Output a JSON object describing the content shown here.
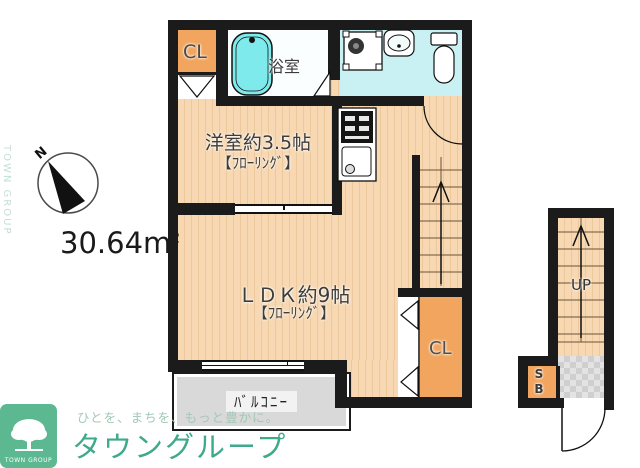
{
  "floorplan": {
    "area_value": "30.64m",
    "area_superscript": "2",
    "compass_north": "N",
    "rooms": {
      "closet_top": "CL",
      "bath": "浴室",
      "western_room_line1": "洋室約3.5帖",
      "western_room_line2": "【ﾌﾛｰﾘﾝｸﾞ】",
      "ldk_line1": "ＬＤＫ約9帖",
      "ldk_line2": "【ﾌﾛｰﾘﾝｸﾞ】",
      "closet_bottom": "CL",
      "balcony": "ﾊﾞﾙｺﾆｰ",
      "stairs_up": "UP",
      "shoe_box": "SB"
    },
    "icons": {
      "compass": "circle-with-black-north-wedge",
      "bathtub": "rounded-rect-tub",
      "toilet": "tank-and-bowl",
      "washbasin": "rounded-rect-with-oval",
      "washer_pan": "square-with-drum-circle",
      "stove": "black-box-with-burners",
      "kitchen_sink": "counter-with-basin",
      "stairs": "treads-with-up-arrow",
      "door_swing": "quarter-circle-arc",
      "folding_door": "hollow-triangles",
      "tree_logo": "white-tree-on-green"
    },
    "colors": {
      "wall": "#1b1b1b",
      "floor_wood": "#f7d8b2",
      "closet_orange": "#f1a55e",
      "wet_area_cyan": "#c9f0f2",
      "bathtub_cyan": "#7eeaec",
      "balcony_gray": "#d9d9d9",
      "tile_gray": "#e3e3e3",
      "brand_green": "#3fa98b",
      "logo_box_green": "#5cb890"
    }
  },
  "branding": {
    "logo_box_text": "TOWN GROUP",
    "brand_name": "タウングループ",
    "tagline": "ひとを、まちを、もっと豊かに。",
    "watermark": "TOWN GROUP"
  }
}
